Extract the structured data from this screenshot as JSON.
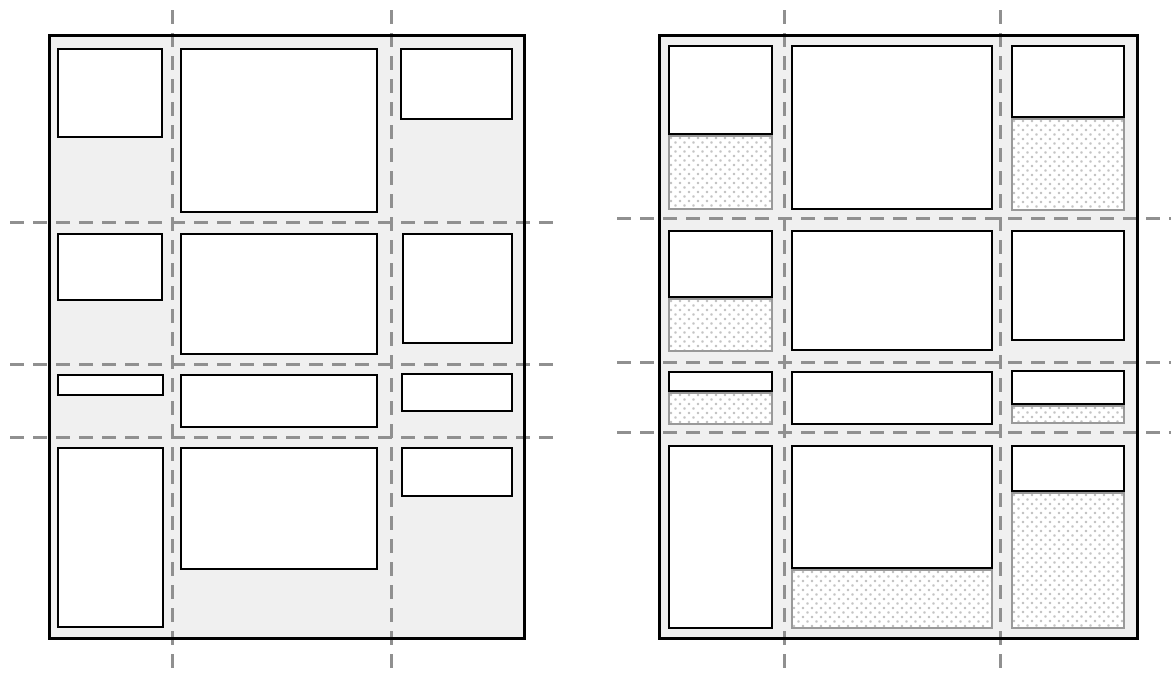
{
  "figure": {
    "background": "#ffffff",
    "colors": {
      "container_fill": "#f0f0f0",
      "container_border": "#000000",
      "item_fill": "#ffffff",
      "item_border": "#000000",
      "gridline": "#909090",
      "slack_border": "#999999",
      "slack_dot": "#c4c4c4",
      "slack_fill": "#ffffff"
    },
    "diagrams": [
      {
        "id": "left-grid-diagram",
        "container": [
          48,
          34,
          478,
          606
        ],
        "gridlines": {
          "vertical": [
            {
              "x": 172,
              "y1": 10,
              "y2": 668
            },
            {
              "x": 391,
              "y1": 10,
              "y2": 668
            }
          ],
          "horizontal": [
            {
              "y": 222,
              "x1": 10,
              "x2": 560
            },
            {
              "y": 364,
              "x1": 10,
              "x2": 560
            },
            {
              "y": 437,
              "x1": 10,
              "x2": 560
            }
          ]
        },
        "cells": [
          {
            "item": [
              57,
              48,
              106,
              90
            ],
            "slack": null
          },
          {
            "item": [
              180,
              48,
              198,
              165
            ],
            "slack": null
          },
          {
            "item": [
              400,
              48,
              113,
              72
            ],
            "slack": null
          },
          {
            "item": [
              57,
              233,
              106,
              68
            ],
            "slack": null
          },
          {
            "item": [
              180,
              233,
              198,
              122
            ],
            "slack": null
          },
          {
            "item": [
              402,
              233,
              111,
              111
            ],
            "slack": null
          },
          {
            "item": [
              57,
              374,
              107,
              22
            ],
            "slack": null
          },
          {
            "item": [
              180,
              374,
              198,
              54
            ],
            "slack": null
          },
          {
            "item": [
              401,
              373,
              112,
              39
            ],
            "slack": null
          },
          {
            "item": [
              57,
              447,
              107,
              181
            ],
            "slack": null
          },
          {
            "item": [
              180,
              447,
              198,
              123
            ],
            "slack": null
          },
          {
            "item": [
              401,
              447,
              112,
              50
            ],
            "slack": null
          }
        ]
      },
      {
        "id": "right-grid-diagram",
        "container": [
          658,
          34,
          481,
          606
        ],
        "gridlines": {
          "vertical": [
            {
              "x": 784,
              "y1": 10,
              "y2": 668
            },
            {
              "x": 1000,
              "y1": 10,
              "y2": 668
            }
          ],
          "horizontal": [
            {
              "y": 218,
              "x1": 617,
              "x2": 1171
            },
            {
              "y": 362,
              "x1": 617,
              "x2": 1171
            },
            {
              "y": 432,
              "x1": 617,
              "x2": 1171
            }
          ]
        },
        "cells": [
          {
            "item": [
              668,
              45,
              105,
              90
            ],
            "slack": [
              668,
              135,
              105,
              75
            ]
          },
          {
            "item": [
              791,
              45,
              202,
              165
            ],
            "slack": null
          },
          {
            "item": [
              1011,
              45,
              114,
              73
            ],
            "slack": [
              1011,
              118,
              114,
              93
            ]
          },
          {
            "item": [
              668,
              230,
              105,
              68
            ],
            "slack": [
              668,
              298,
              105,
              54
            ]
          },
          {
            "item": [
              791,
              230,
              202,
              121
            ],
            "slack": null
          },
          {
            "item": [
              1011,
              230,
              114,
              111
            ],
            "slack": null
          },
          {
            "item": [
              668,
              371,
              105,
              21
            ],
            "slack": [
              668,
              392,
              105,
              33
            ]
          },
          {
            "item": [
              791,
              371,
              202,
              54
            ],
            "slack": null
          },
          {
            "item": [
              1011,
              370,
              114,
              35
            ],
            "slack": [
              1011,
              405,
              114,
              19
            ]
          },
          {
            "item": [
              668,
              445,
              105,
              184
            ],
            "slack": null
          },
          {
            "item": [
              791,
              445,
              202,
              124
            ],
            "slack": [
              791,
              569,
              202,
              60
            ]
          },
          {
            "item": [
              1011,
              445,
              114,
              47
            ],
            "slack": [
              1011,
              492,
              114,
              137
            ]
          }
        ]
      }
    ]
  }
}
